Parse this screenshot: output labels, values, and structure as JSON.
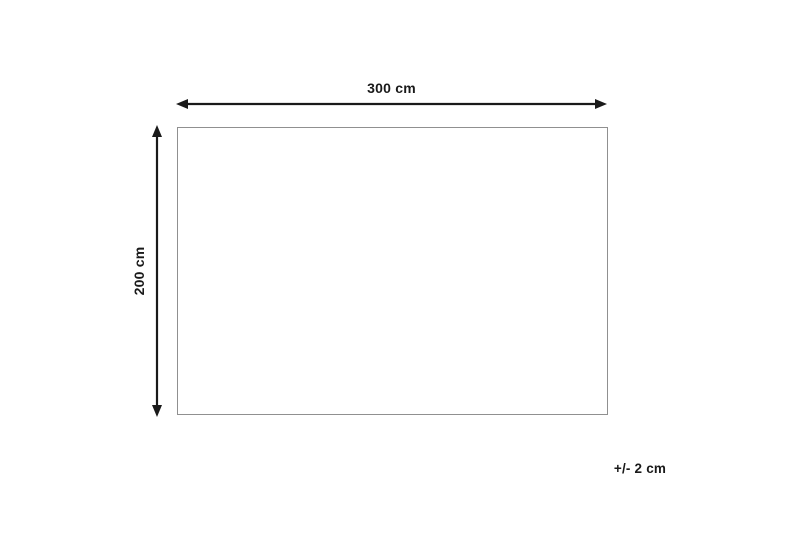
{
  "diagram": {
    "width_dimension": {
      "label": "300 cm",
      "value_cm": 300
    },
    "height_dimension": {
      "label": "200 cm",
      "value_cm": 200
    },
    "tolerance": {
      "label": "+/- 2 cm",
      "value_cm": 2
    },
    "colors": {
      "background": "#ffffff",
      "rectangle_outline": "#909090",
      "arrow_and_text": "#1a1a1a"
    }
  }
}
